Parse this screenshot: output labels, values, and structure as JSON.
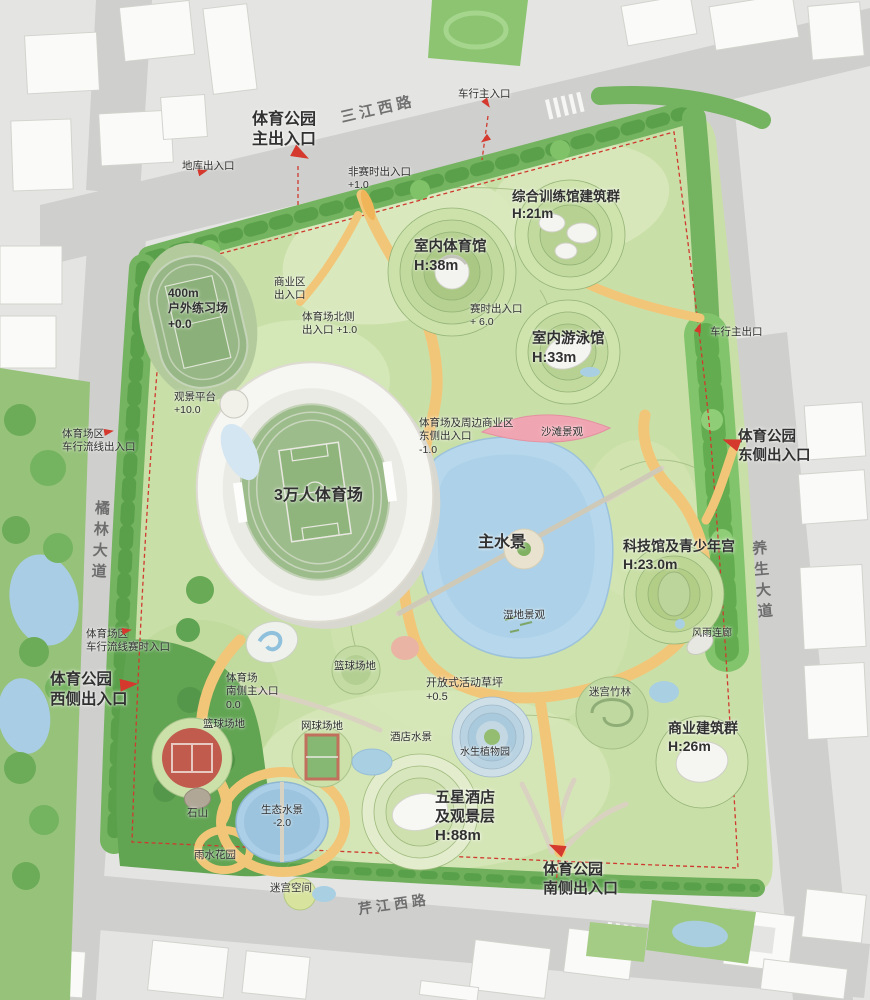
{
  "plan_title": "体育公园总平面",
  "colors": {
    "entrance_red": "#d5382c",
    "boundary_dash_red": "#cf3a2e",
    "path_yellow": "#f2c678",
    "water_blue": "#b6d7ec",
    "park_green": "#c9dfa8",
    "tree_green": "#6bac57",
    "beach_pink": "#f0a6b2",
    "road_gray": "#cfcfcd",
    "building_white": "#fafaf8",
    "label_dark": "#313131",
    "road_label_gray": "#5e5e5e"
  },
  "map_labels": [
    {
      "name": "park-main-entrance",
      "text": "体育公园\n主出入口",
      "x": 252,
      "y": 110,
      "size": 16,
      "bold": true,
      "center": true
    },
    {
      "name": "road-sanjiangxilu",
      "text": "三江西路",
      "x": 340,
      "y": 100,
      "size": 15,
      "road": true,
      "rotate": -13
    },
    {
      "name": "vehicle-main-entrance",
      "text": "车行主入口",
      "x": 458,
      "y": 88,
      "size": 10.5
    },
    {
      "name": "garage-entrance",
      "text": "地库出入口",
      "x": 182,
      "y": 160,
      "size": 10.5
    },
    {
      "name": "offseason-entrance",
      "text": "非赛时出入口\n+1.0",
      "x": 348,
      "y": 166,
      "size": 10.5
    },
    {
      "name": "training-hall-complex",
      "text": "综合训练馆建筑群\nH:21m",
      "x": 512,
      "y": 188,
      "size": 13.5,
      "bold": true
    },
    {
      "name": "indoor-gym",
      "text": "室内体育馆\nH:38m",
      "x": 414,
      "y": 238,
      "size": 14.5,
      "bold": true
    },
    {
      "name": "match-entrance",
      "text": "赛时出入口\n+ 6.0",
      "x": 470,
      "y": 303,
      "size": 10.5
    },
    {
      "name": "indoor-pool",
      "text": "室内游泳馆\nH:33m",
      "x": 532,
      "y": 330,
      "size": 14.5,
      "bold": true
    },
    {
      "name": "vehicle-main-exit",
      "text": "车行主出口",
      "x": 710,
      "y": 326,
      "size": 10.5
    },
    {
      "name": "east-entrance",
      "text": "体育公园\n东侧出入口",
      "x": 738,
      "y": 428,
      "size": 14.5,
      "bold": true
    },
    {
      "name": "practice-field",
      "text": "400m\n户外练习场\n+0.0",
      "x": 168,
      "y": 286,
      "size": 12,
      "bold": true
    },
    {
      "name": "commercial-entrance",
      "text": "商业区\n出入口",
      "x": 274,
      "y": 276,
      "size": 10.5
    },
    {
      "name": "stadium-north-entrance",
      "text": "体育场北侧\n出入口 +1.0",
      "x": 302,
      "y": 311,
      "size": 10.5
    },
    {
      "name": "viewing-platform",
      "text": "观景平台\n+10.0",
      "x": 174,
      "y": 391,
      "size": 10.5
    },
    {
      "name": "stadium-vehicle-entrance",
      "text": "体育场区\n车行流线出入口",
      "x": 62,
      "y": 428,
      "size": 10.5
    },
    {
      "name": "stadium",
      "text": "3万人体育场",
      "x": 274,
      "y": 486,
      "size": 16,
      "bold": true
    },
    {
      "name": "stadium-commercial-east-entrance",
      "text": "体育场及周边商业区\n东侧出入口\n-1.0",
      "x": 419,
      "y": 417,
      "size": 10.5
    },
    {
      "name": "beach-landscape",
      "text": "沙滩景观",
      "x": 541,
      "y": 426,
      "size": 10.5
    },
    {
      "name": "main-water",
      "text": "主水景",
      "x": 478,
      "y": 533,
      "size": 16,
      "bold": true
    },
    {
      "name": "science-youth-hall",
      "text": "科技馆及青少年宫\nH:23.0m",
      "x": 623,
      "y": 538,
      "size": 14,
      "bold": true
    },
    {
      "name": "wetland",
      "text": "湿地景观",
      "x": 503,
      "y": 609,
      "size": 10.5
    },
    {
      "name": "covered-corridor",
      "text": "风雨连廊",
      "x": 692,
      "y": 628,
      "size": 10
    },
    {
      "name": "stadium-vehicle-match-entrance",
      "text": "体育场区\n车行流线赛时入口",
      "x": 86,
      "y": 628,
      "size": 10.5
    },
    {
      "name": "west-entrance",
      "text": "体育公园\n西侧出入口",
      "x": 50,
      "y": 670,
      "size": 15.5,
      "bold": true
    },
    {
      "name": "stadium-south-entrance",
      "text": "体育场\n南侧主入口\n0.0",
      "x": 226,
      "y": 672,
      "size": 10.5
    },
    {
      "name": "basketball-court-north",
      "text": "篮球场地",
      "x": 334,
      "y": 660,
      "size": 10.5
    },
    {
      "name": "open-lawn",
      "text": "开放式活动草坪\n+0.5",
      "x": 426,
      "y": 676,
      "size": 11
    },
    {
      "name": "bamboo-maze",
      "text": "迷宫竹林",
      "x": 589,
      "y": 686,
      "size": 10.5
    },
    {
      "name": "commercial-buildings",
      "text": "商业建筑群\nH:26m",
      "x": 668,
      "y": 720,
      "size": 14,
      "bold": true
    },
    {
      "name": "basketball-court-west",
      "text": "篮球场地",
      "x": 203,
      "y": 718,
      "size": 10.5
    },
    {
      "name": "tennis-court",
      "text": "网球场地",
      "x": 301,
      "y": 720,
      "size": 10.5
    },
    {
      "name": "hotel-water",
      "text": "酒店水景",
      "x": 390,
      "y": 731,
      "size": 10.5
    },
    {
      "name": "aquatic-plant-garden",
      "text": "水生植物园",
      "x": 460,
      "y": 747,
      "size": 10
    },
    {
      "name": "five-star-hotel",
      "text": "五星酒店\n及观景层\nH:88m",
      "x": 435,
      "y": 788,
      "size": 15,
      "bold": true
    },
    {
      "name": "eco-water",
      "text": "生态水景\n-2.0",
      "x": 261,
      "y": 804,
      "size": 10.5,
      "center": true
    },
    {
      "name": "rock-hill",
      "text": "石山",
      "x": 187,
      "y": 807,
      "size": 10.5
    },
    {
      "name": "rain-garden",
      "text": "雨水花园",
      "x": 194,
      "y": 849,
      "size": 10.5
    },
    {
      "name": "maze-space",
      "text": "迷宫空间",
      "x": 270,
      "y": 882,
      "size": 10.5
    },
    {
      "name": "south-entrance",
      "text": "体育公园\n南侧出入口",
      "x": 543,
      "y": 860,
      "size": 15,
      "bold": true
    },
    {
      "name": "road-qinjiangxilu",
      "text": "芹江西路",
      "x": 358,
      "y": 896,
      "size": 14,
      "road": true,
      "rotate": -8
    },
    {
      "name": "road-julindadao",
      "text": "橘林大道",
      "x": 90,
      "y": 500,
      "size": 15,
      "road": true,
      "vertical": true,
      "rotate": 3
    },
    {
      "name": "road-yangshengdadao",
      "text": "养生大道",
      "x": 752,
      "y": 540,
      "size": 15,
      "road": true,
      "vertical": true,
      "rotate": -5
    }
  ],
  "entrance_arrows": [
    {
      "x": 292,
      "y": 148,
      "rotate": 28,
      "size": 18
    },
    {
      "x": 482,
      "y": 100,
      "rotate": 55,
      "size": 10
    },
    {
      "x": 198,
      "y": 168,
      "rotate": -15,
      "size": 10
    },
    {
      "x": 480,
      "y": 136,
      "rotate": 145,
      "size": 10
    },
    {
      "x": 694,
      "y": 324,
      "rotate": -70,
      "size": 10
    },
    {
      "x": 722,
      "y": 436,
      "rotate": 200,
      "size": 18
    },
    {
      "x": 104,
      "y": 428,
      "rotate": -10,
      "size": 10
    },
    {
      "x": 122,
      "y": 627,
      "rotate": -10,
      "size": 10
    },
    {
      "x": 120,
      "y": 678,
      "rotate": -5,
      "size": 18
    },
    {
      "x": 548,
      "y": 842,
      "rotate": 205,
      "size": 17
    }
  ]
}
